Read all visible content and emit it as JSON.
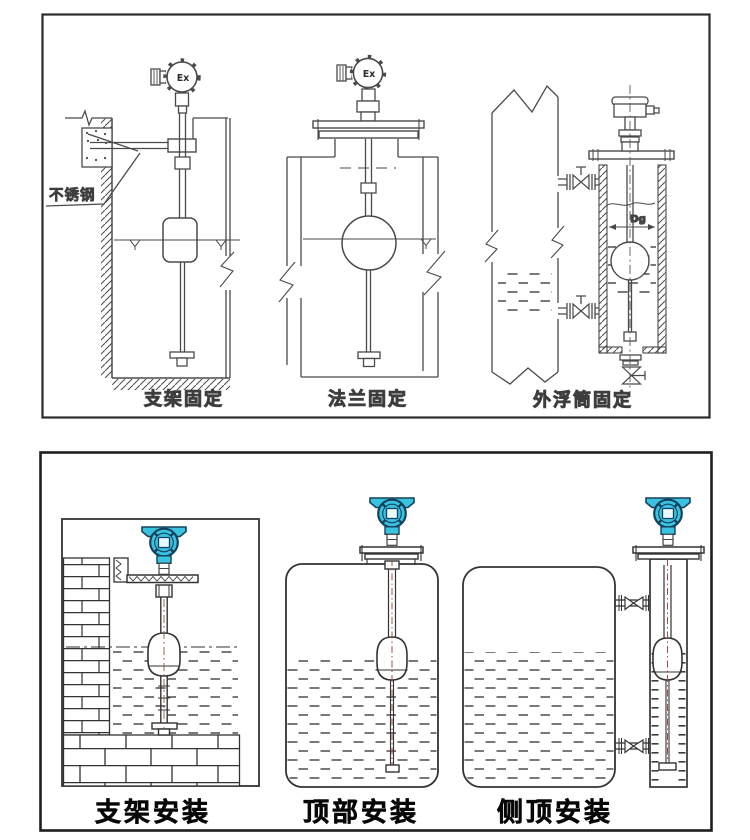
{
  "panel1": {
    "drawings": [
      {
        "caption": "支架固定",
        "head_marking": "Ex",
        "material_note": "不锈钢"
      },
      {
        "caption": "法兰固定",
        "head_marking": "Ex"
      },
      {
        "caption": "外浮筒固定",
        "diameter_label": "Dg"
      }
    ]
  },
  "panel2": {
    "drawings": [
      {
        "caption": "支架安装"
      },
      {
        "caption": "顶部安装"
      },
      {
        "caption": "侧顶安装"
      }
    ]
  },
  "colors": {
    "line": "#4a4a4a",
    "transmitter_body": "#3ac3e0",
    "transmitter_outline": "#14425e",
    "stem_centerline": "#9c5040"
  }
}
